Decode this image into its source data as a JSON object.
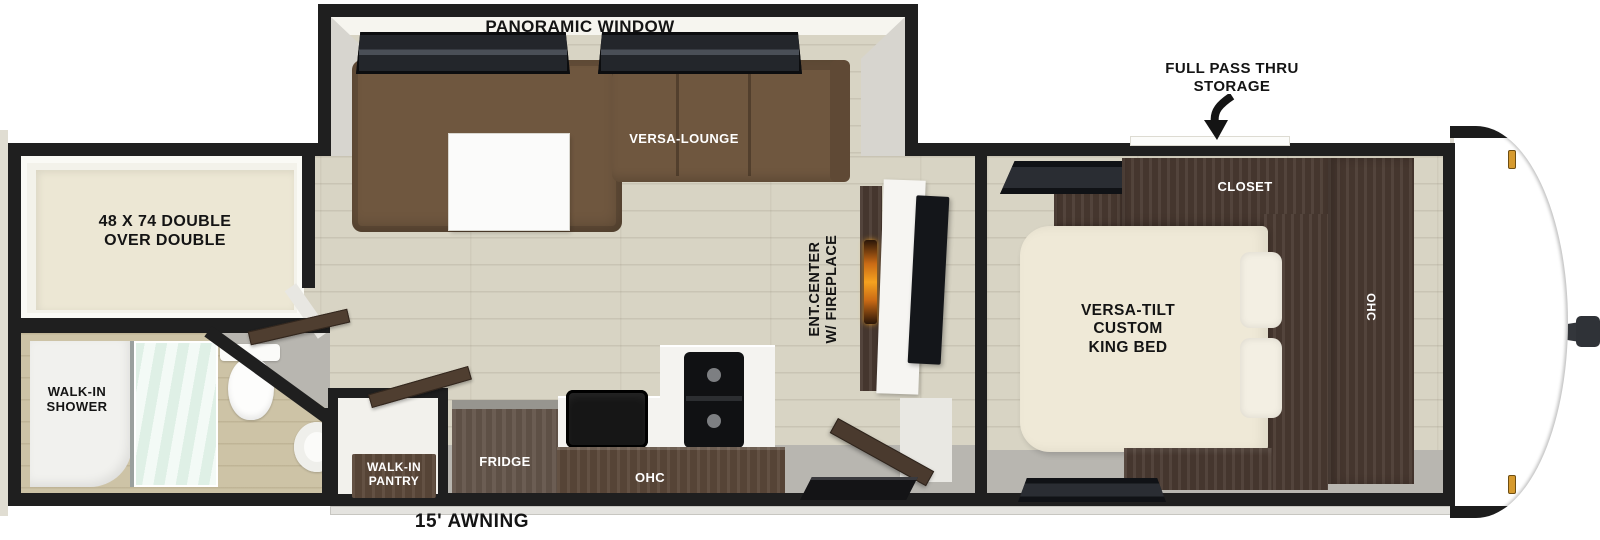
{
  "floorplan": {
    "slideout": {
      "window_label": "PANORAMIC WINDOW",
      "lounge_label": "VERSA-LOUNGE"
    },
    "storage_callout": "FULL PASS THRU\nSTORAGE",
    "bedroom": {
      "closet_label": "CLOSET",
      "ohc_label": "OHC",
      "bed_label": "VERSA-TILT\nCUSTOM\nKING BED"
    },
    "bunk_label": "48 X 74 DOUBLE\nOVER DOUBLE",
    "bath": {
      "shower_label": "WALK-IN\nSHOWER"
    },
    "kitchen": {
      "pantry_label": "WALK-IN\nPANTRY",
      "fridge_label": "FRIDGE",
      "ohc_label": "OHC"
    },
    "living": {
      "ent_center_label": "ENT.CENTER\nW/ FIREPLACE"
    },
    "exterior": {
      "awning_label": "15' AWNING"
    }
  },
  "colors": {
    "wall": "#1f1f1f",
    "floor_wood": "#d8d4c4",
    "floor_bath": "#cdc3a6",
    "walkway_gray": "#b8b6b0",
    "sofa_brown": "#6f573f",
    "cabinet_dark_wood": "#4a3a31",
    "bed_cream": "#efe9d7",
    "shower_glass": "#dff0e6",
    "flame_orange": "#f6a21f",
    "clearance_light_amber": "#d69a2e"
  }
}
